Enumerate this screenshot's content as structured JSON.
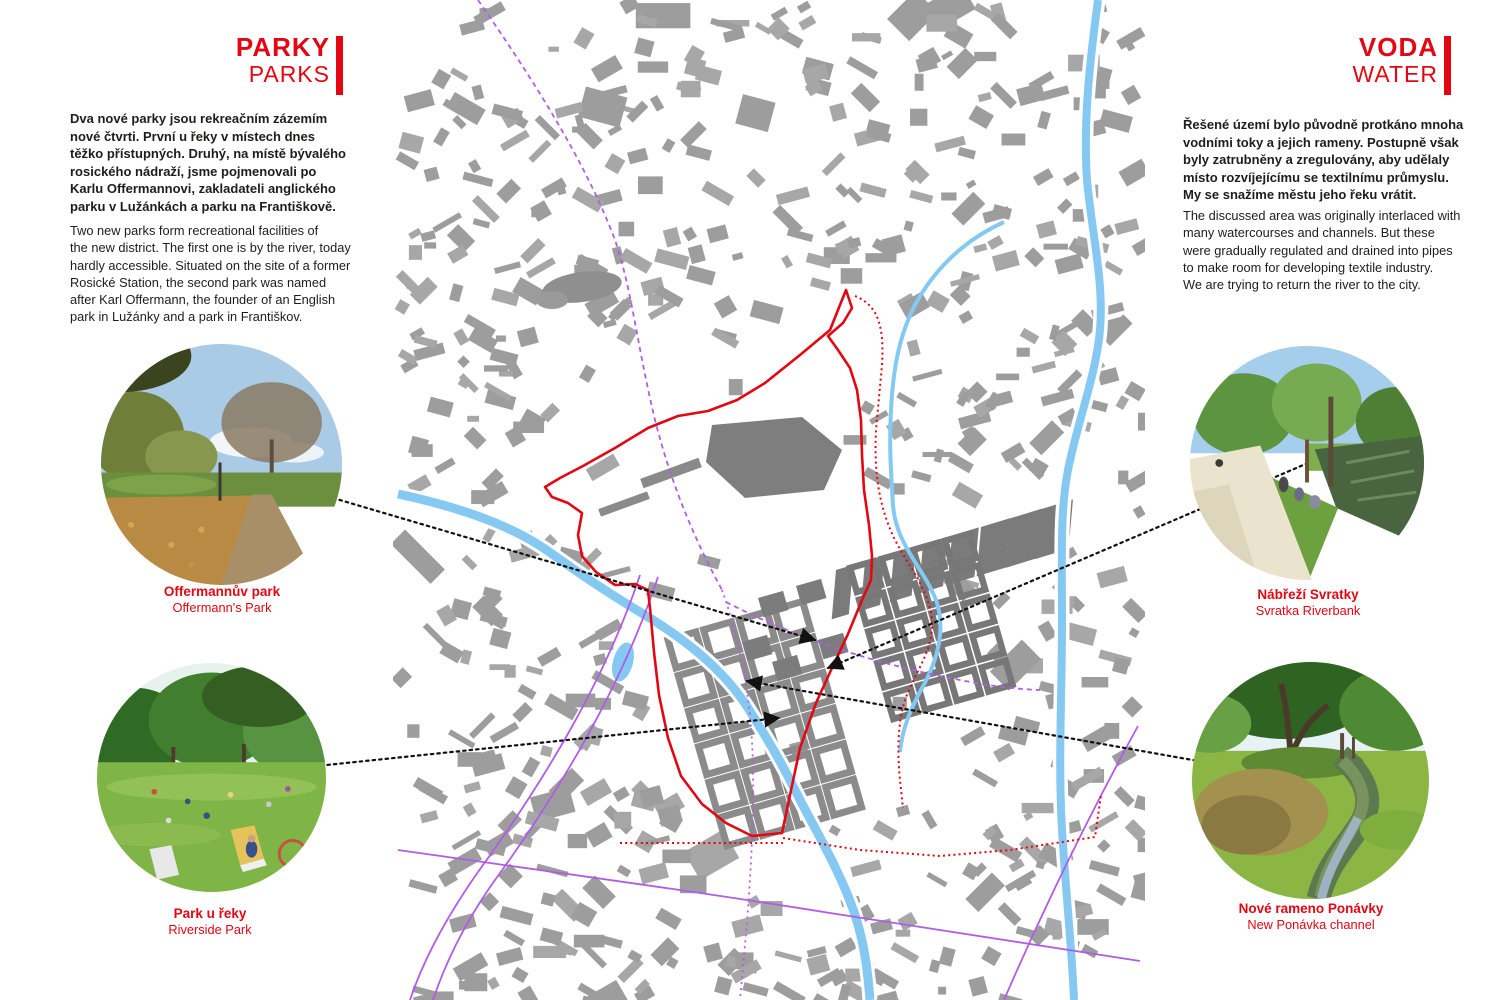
{
  "accent_red": "#e30613",
  "text_color": "#1d1d1b",
  "left_panel": {
    "title_cz": "PARKY",
    "title_en": "PARKS",
    "para_cz": "Dva nové parky jsou rekreačním zázemím\nnové čtvrti. První u řeky v místech dnes\ntěžko přístupných. Druhý, na místě bývalého\nrosického nádraží, jsme pojmenovali po\nKarlu Offermannovi, zakladateli anglického\nparku v Lužánkách a parku na Františkově.",
    "para_en": "Two new parks form recreational facilities of\nthe new district. The first one is by the river, today\nhardly accessible. Situated on the site of a former\nRosické Station, the second park was named\nafter Karl Offermann, the founder of an English\npark in Lužánky and a park in Františkov.",
    "photos": [
      {
        "caption_cz": "Offermannův park",
        "caption_en": "Offermann's Park"
      },
      {
        "caption_cz": "Park u řeky",
        "caption_en": "Riverside Park"
      }
    ]
  },
  "right_panel": {
    "title_cz": "VODA",
    "title_en": "WATER",
    "para_cz": "Řešené území bylo původně protkáno mnoha\nvodními toky a jejich rameny. Postupně však\nbyly zatrubněny a zregulovány, aby udělaly\nmísto rozvíjejícímu se textilnímu průmyslu.\nMy se snažíme městu jeho řeku vrátit.",
    "para_en": "The discussed area was originally interlaced with\nmany watercourses and channels. But these\nwere gradually regulated and drained into pipes\nto make room for developing textile industry.\nWe are trying to return the river to the city.",
    "photos": [
      {
        "caption_cz": "Nábřeží Svratky",
        "caption_en": "Svratka Riverbank"
      },
      {
        "caption_cz": "Nové rameno Ponávky",
        "caption_en": "New Ponávka channel"
      }
    ]
  },
  "map": {
    "colors": {
      "building": "#9d9d9d",
      "proposed_block": "#7b7b7b",
      "water": "#85c9f2",
      "rail": "#b15ce6",
      "boundary": "#e30613",
      "leader": "#111111"
    }
  }
}
